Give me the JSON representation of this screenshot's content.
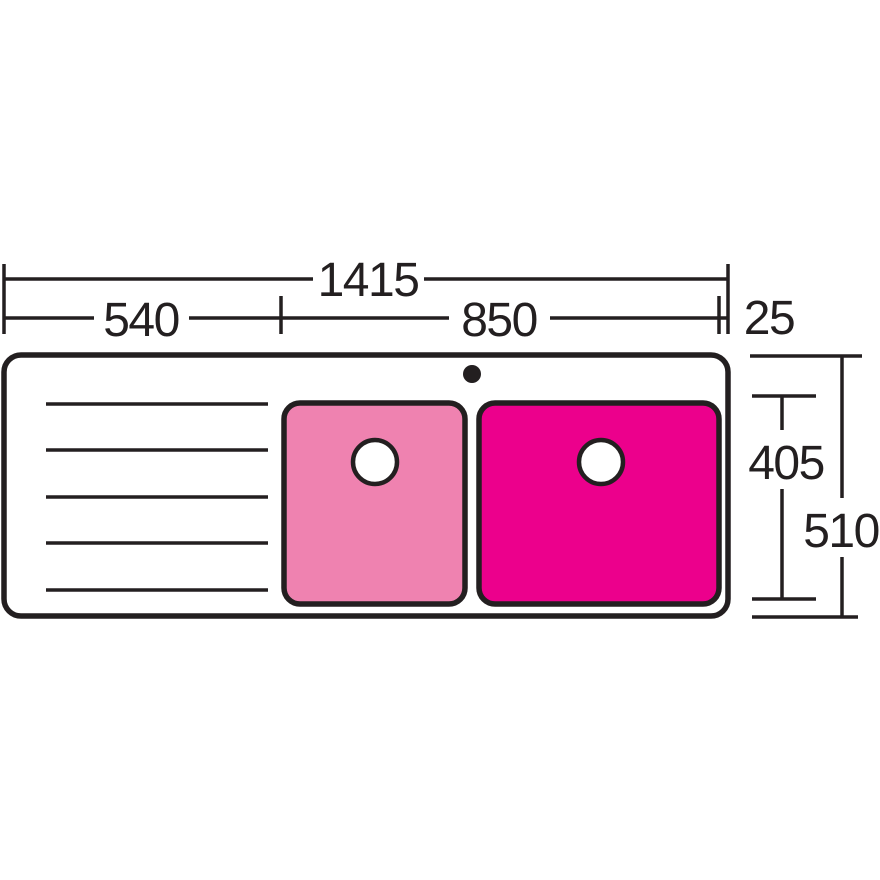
{
  "drawing": {
    "type": "technical-drawing",
    "subject": "double-bowl-sink-with-left-drainer-top-view"
  },
  "colors": {
    "line": "#231F20",
    "background": "#FFFFFF",
    "left_bowl_fill": "#EF82B0",
    "right_bowl_fill": "#EC008C",
    "drain_fill": "#FFFFFF"
  },
  "dimensions": {
    "overall_width": "1415",
    "drainer_width": "540",
    "bowl_section_width": "850",
    "right_rim_width": "25",
    "bowl_depth": "405",
    "overall_depth": "510"
  }
}
